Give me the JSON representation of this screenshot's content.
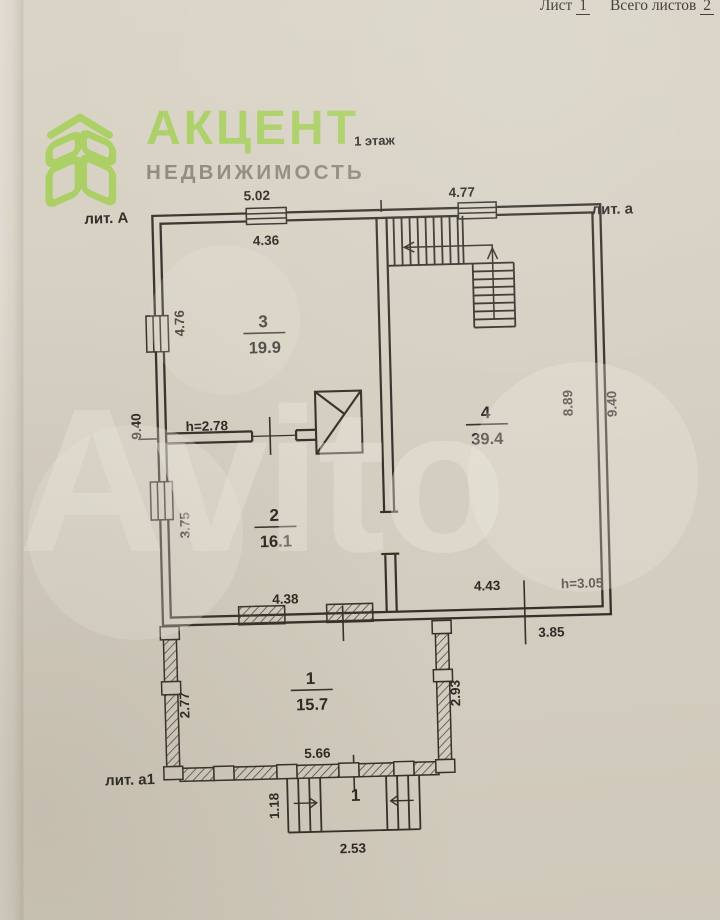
{
  "document": {
    "sheet_label": "Лист",
    "sheet_number": "1",
    "total_sheets_label": "Всего листов",
    "total_sheets_number": "2",
    "floor_label": "1 этаж"
  },
  "logo": {
    "brand": "АКЦЕНТ",
    "subtitle": "НЕДВИЖИМОСТЬ",
    "brand_color": "#a8cf5e",
    "subtitle_color": "#7f7868",
    "icon": "cube-leaf-logo"
  },
  "watermark": {
    "text": "Avito"
  },
  "plan": {
    "literas": {
      "main": "лит. А",
      "annex": "лит. а",
      "veranda": "лит. а1"
    },
    "rooms": [
      {
        "number": "3",
        "area": "19.9",
        "height": "h=2.78"
      },
      {
        "number": "4",
        "area": "39.4",
        "height": "h=3.05"
      },
      {
        "number": "2",
        "area": "16.1"
      },
      {
        "number": "1",
        "area": "15.7"
      }
    ],
    "porch_number": "1",
    "dims": {
      "top_left": "5.02",
      "top_right": "4.77",
      "room3_top": "4.36",
      "room3_left": "4.76",
      "left_total": "9.40",
      "room2_left": "3.75",
      "room2_bottom": "4.38",
      "room4_right_inner": "8.89",
      "right_total": "9.40",
      "room4_bottom": "4.43",
      "bottom_offset": "3.85",
      "veranda_left": "2.77",
      "veranda_right": "2.93",
      "veranda_bottom": "5.66",
      "porch_side": "1.18",
      "porch_bottom": "2.53"
    },
    "colors": {
      "paper": "#d8d2c4",
      "ink": "#2f2b26"
    }
  }
}
